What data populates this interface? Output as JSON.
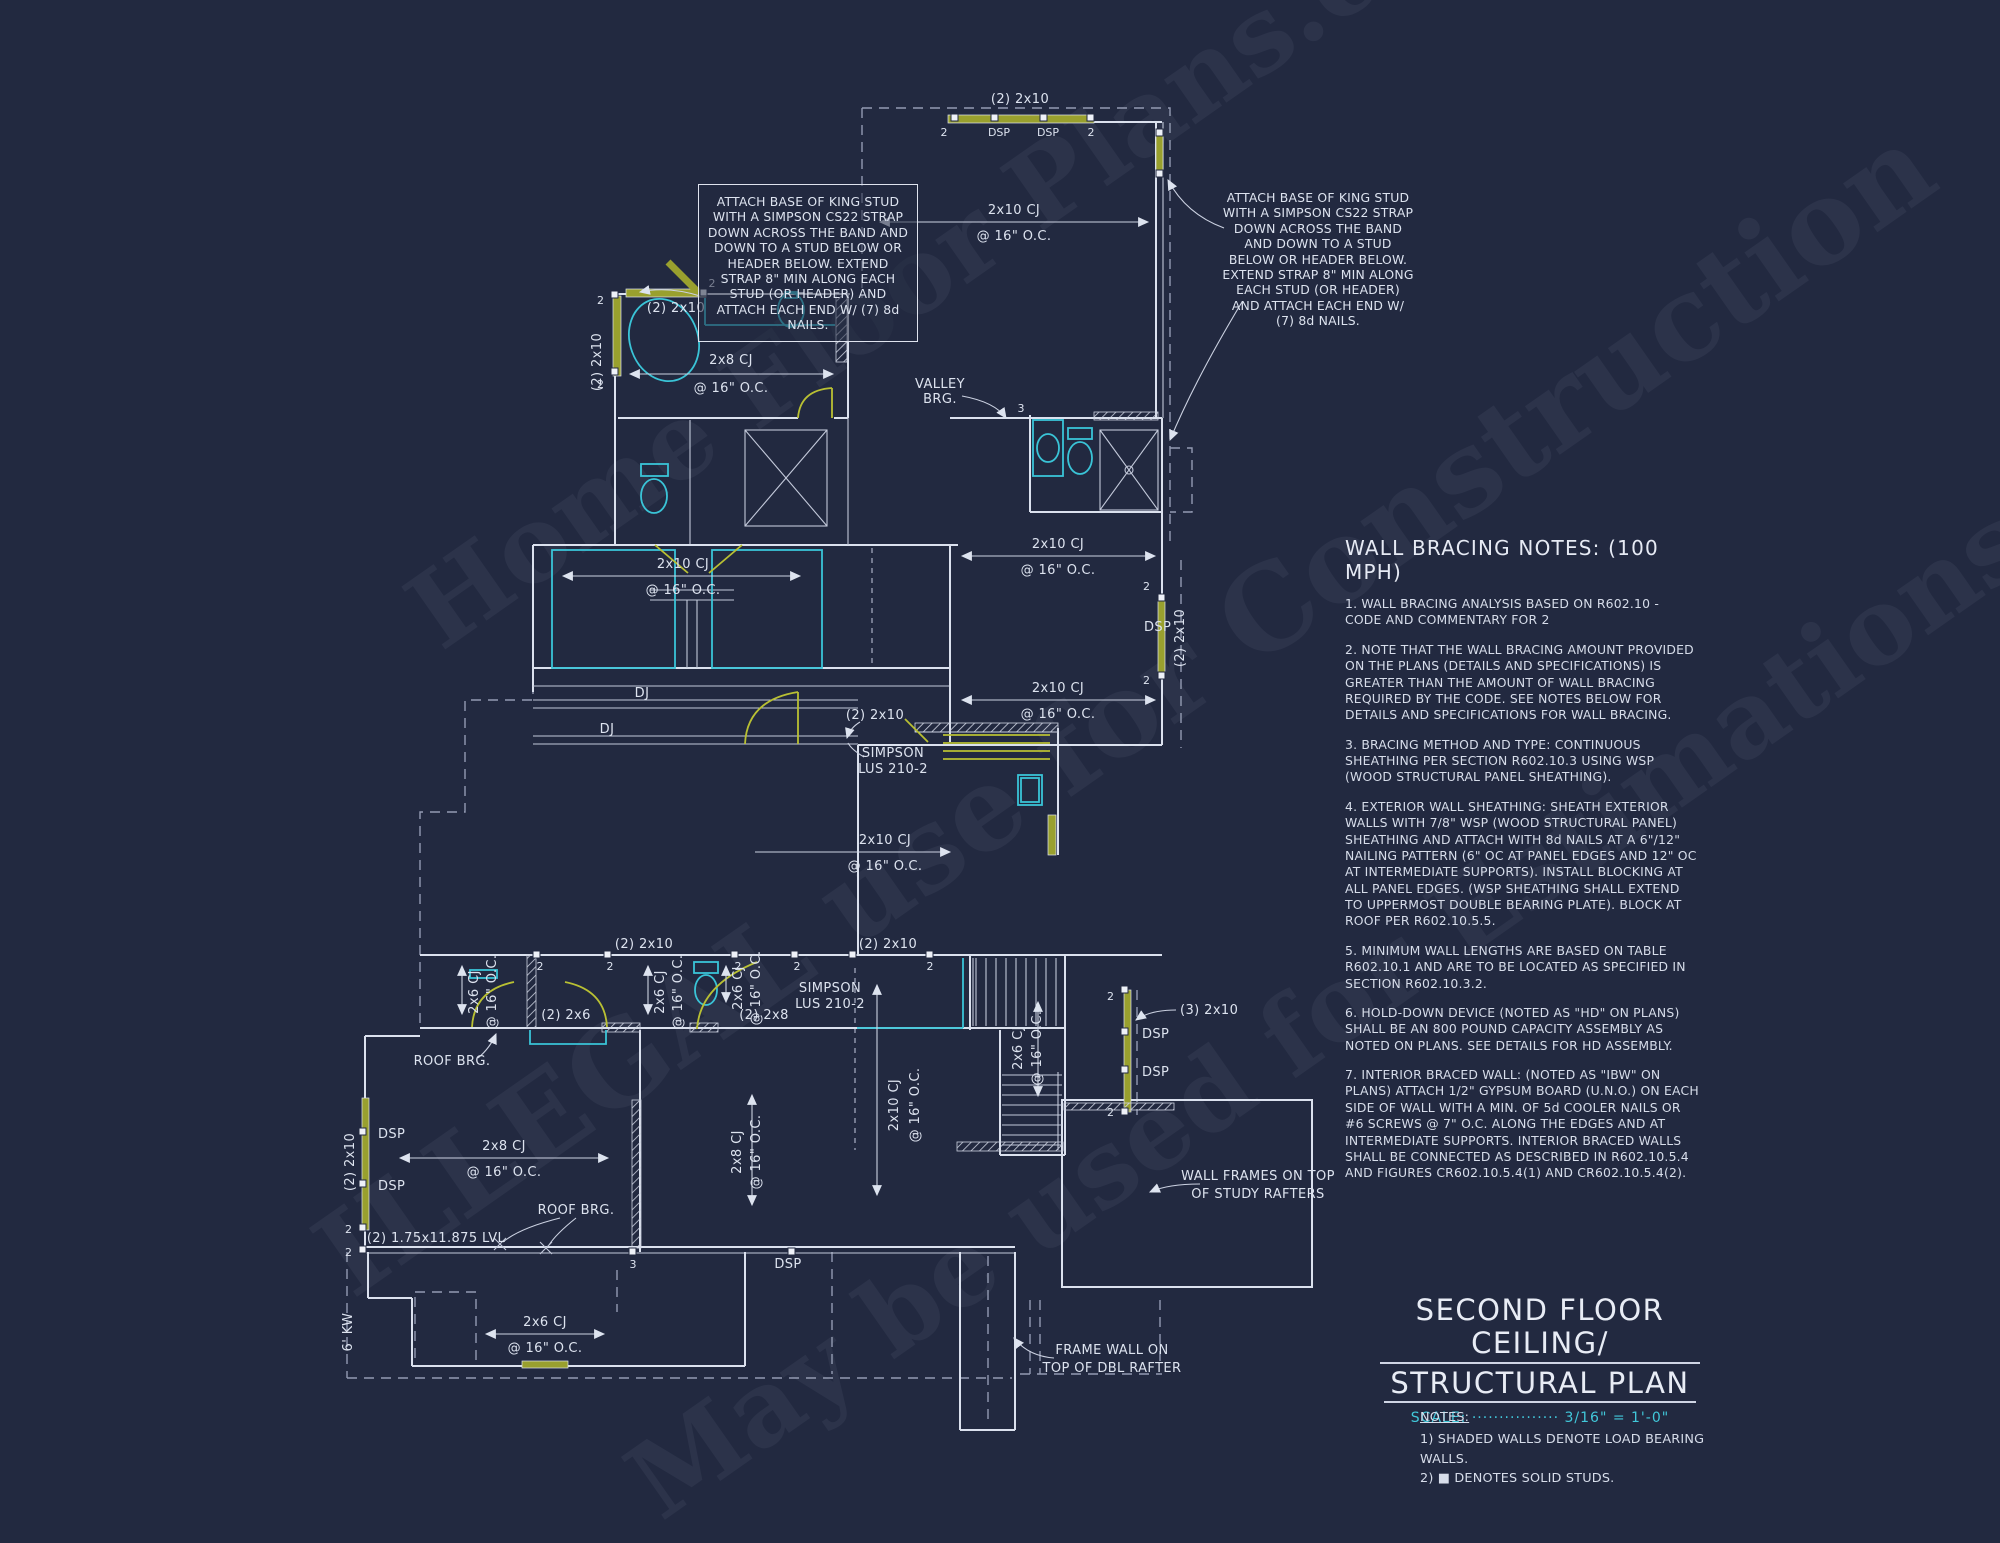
{
  "watermark": {
    "line1": "Home Floor Plans.com",
    "line2": "ILLEGAL use for Construction",
    "line3": "May be used for Estimations"
  },
  "annotations": {
    "king_stud": "ATTACH BASE OF KING STUD WITH A SIMPSON CS22 STRAP DOWN ACROSS THE BAND AND DOWN TO A STUD BELOW OR HEADER BELOW.  EXTEND STRAP 8\" MIN ALONG EACH STUD (OR HEADER) AND ATTACH EACH END W/ (7) 8d NAILS."
  },
  "wall_bracing": {
    "title": "WALL BRACING NOTES: (100 MPH)",
    "items": [
      "1. WALL BRACING ANALYSIS BASED ON R602.10 - CODE AND COMMENTARY FOR 2",
      "2. NOTE THAT THE WALL BRACING AMOUNT PROVIDED ON THE PLANS (DETAILS AND SPECIFICATIONS) IS GREATER THAN THE AMOUNT OF WALL BRACING REQUIRED BY THE CODE. SEE NOTES BELOW FOR DETAILS AND SPECIFICATIONS FOR WALL BRACING.",
      "3. BRACING METHOD AND TYPE: CONTINUOUS SHEATHING PER SECTION R602.10.3 USING WSP (WOOD STRUCTURAL PANEL SHEATHING).",
      "4. EXTERIOR WALL SHEATHING: SHEATH EXTERIOR WALLS WITH 7/8\" WSP (WOOD STRUCTURAL PANEL) SHEATHING AND ATTACH WITH 8d NAILS AT A 6\"/12\" NAILING PATTERN (6\" OC AT PANEL EDGES AND 12\" OC AT INTERMEDIATE SUPPORTS). INSTALL BLOCKING AT ALL PANEL EDGES. (WSP SHEATHING SHALL EXTEND TO UPPERMOST DOUBLE BEARING PLATE). BLOCK AT ROOF PER R602.10.5.5.",
      "5. MINIMUM WALL LENGTHS ARE BASED ON TABLE R602.10.1 AND ARE TO BE LOCATED AS SPECIFIED IN SECTION R602.10.3.2.",
      "6. HOLD-DOWN DEVICE (NOTED AS \"HD\" ON PLANS) SHALL BE AN 800 POUND CAPACITY ASSEMBLY AS NOTED ON PLANS. SEE DETAILS FOR HD ASSEMBLY.",
      "7. INTERIOR BRACED WALL: (NOTED AS \"IBW\" ON PLANS) ATTACH 1/2\" GYPSUM BOARD (U.N.O.) ON EACH SIDE OF WALL WITH A MIN. OF 5d COOLER NAILS OR #6 SCREWS @ 7\" O.C. ALONG THE EDGES AND AT INTERMEDIATE SUPPORTS.  INTERIOR BRACED WALLS SHALL BE CONNECTED AS DESCRIBED IN R602.10.5.4 AND FIGURES CR602.10.5.4(1) AND CR602.10.5.4(2)."
    ]
  },
  "title_block": {
    "line1": "SECOND FLOOR CEILING/",
    "line2": "STRUCTURAL PLAN",
    "scale_label": "SCALE:",
    "scale_dots": "················",
    "scale_value": "3/16\" = 1'-0\""
  },
  "notes_block": {
    "title": "NOTES:",
    "items": [
      "1) SHADED WALLS DENOTE LOAD BEARING WALLS.",
      "2) ■ DENOTES SOLID STUDS."
    ]
  },
  "plan": {
    "beam_2_2x10": "(2) 2x10",
    "beam_2_2x6": "(2) 2x6",
    "beam_2_2x8": "(2) 2x8",
    "beam_3_2x10": "(3) 2x10",
    "lvl_beam": "(2) 1.75x11.875 LVL",
    "dsp": "DSP",
    "dj": "DJ",
    "marker_2": "2",
    "marker_3": "3",
    "cj_2x10": "2x10 CJ",
    "cj_2x8": "2x8 CJ",
    "cj_2x6": "2x6 CJ",
    "oc_16": "@ 16\" O.C.",
    "valley_brg_l1": "VALLEY",
    "valley_brg_l2": "BRG.",
    "simpson_l1": "SIMPSON",
    "simpson_l2": "LUS 210-2",
    "roof_brg": "ROOF BRG.",
    "knee_wall": "6' KW",
    "wall_frames_l1": "WALL FRAMES ON TOP",
    "wall_frames_l2": "OF STUDY RAFTERS",
    "frame_wall_l1": "FRAME WALL ON",
    "frame_wall_l2": "TOP OF DBL RAFTER"
  }
}
